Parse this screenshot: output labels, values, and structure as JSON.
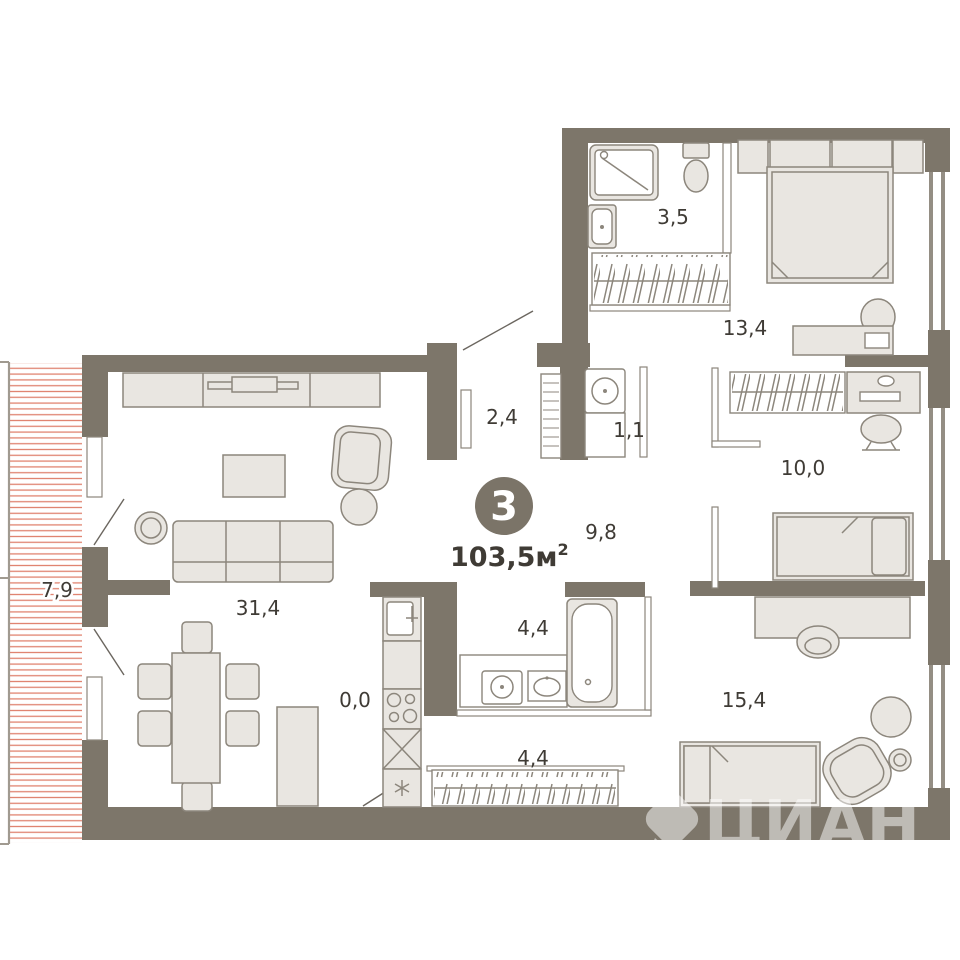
{
  "plan": {
    "rooms_count": "3",
    "total_area": "103,5",
    "total_area_unit": "м",
    "total_area_sup": "2",
    "watermark": "ЦИАН",
    "rooms": [
      {
        "name": "balcony",
        "area": "7,9"
      },
      {
        "name": "living-room",
        "area": "31,4"
      },
      {
        "name": "kitchen-niche",
        "area": "0,0"
      },
      {
        "name": "entry-hall",
        "area": "2,4"
      },
      {
        "name": "laundry-closet",
        "area": "1,1"
      },
      {
        "name": "corridor",
        "area": "9,8"
      },
      {
        "name": "shower-room",
        "area": "3,5"
      },
      {
        "name": "bedroom-master",
        "area": "13,4"
      },
      {
        "name": "bedroom-middle",
        "area": "10,0"
      },
      {
        "name": "bathroom",
        "area": "4,4"
      },
      {
        "name": "wardrobe",
        "area": "4,4"
      },
      {
        "name": "bedroom-large",
        "area": "15,4"
      }
    ],
    "colors": {
      "wall": "#7d766a",
      "furniture_fill": "#e9e6e1",
      "furniture_stroke": "#8c867c",
      "balcony_hatch": "#e0836f",
      "label_text": "#3f3b35"
    }
  }
}
